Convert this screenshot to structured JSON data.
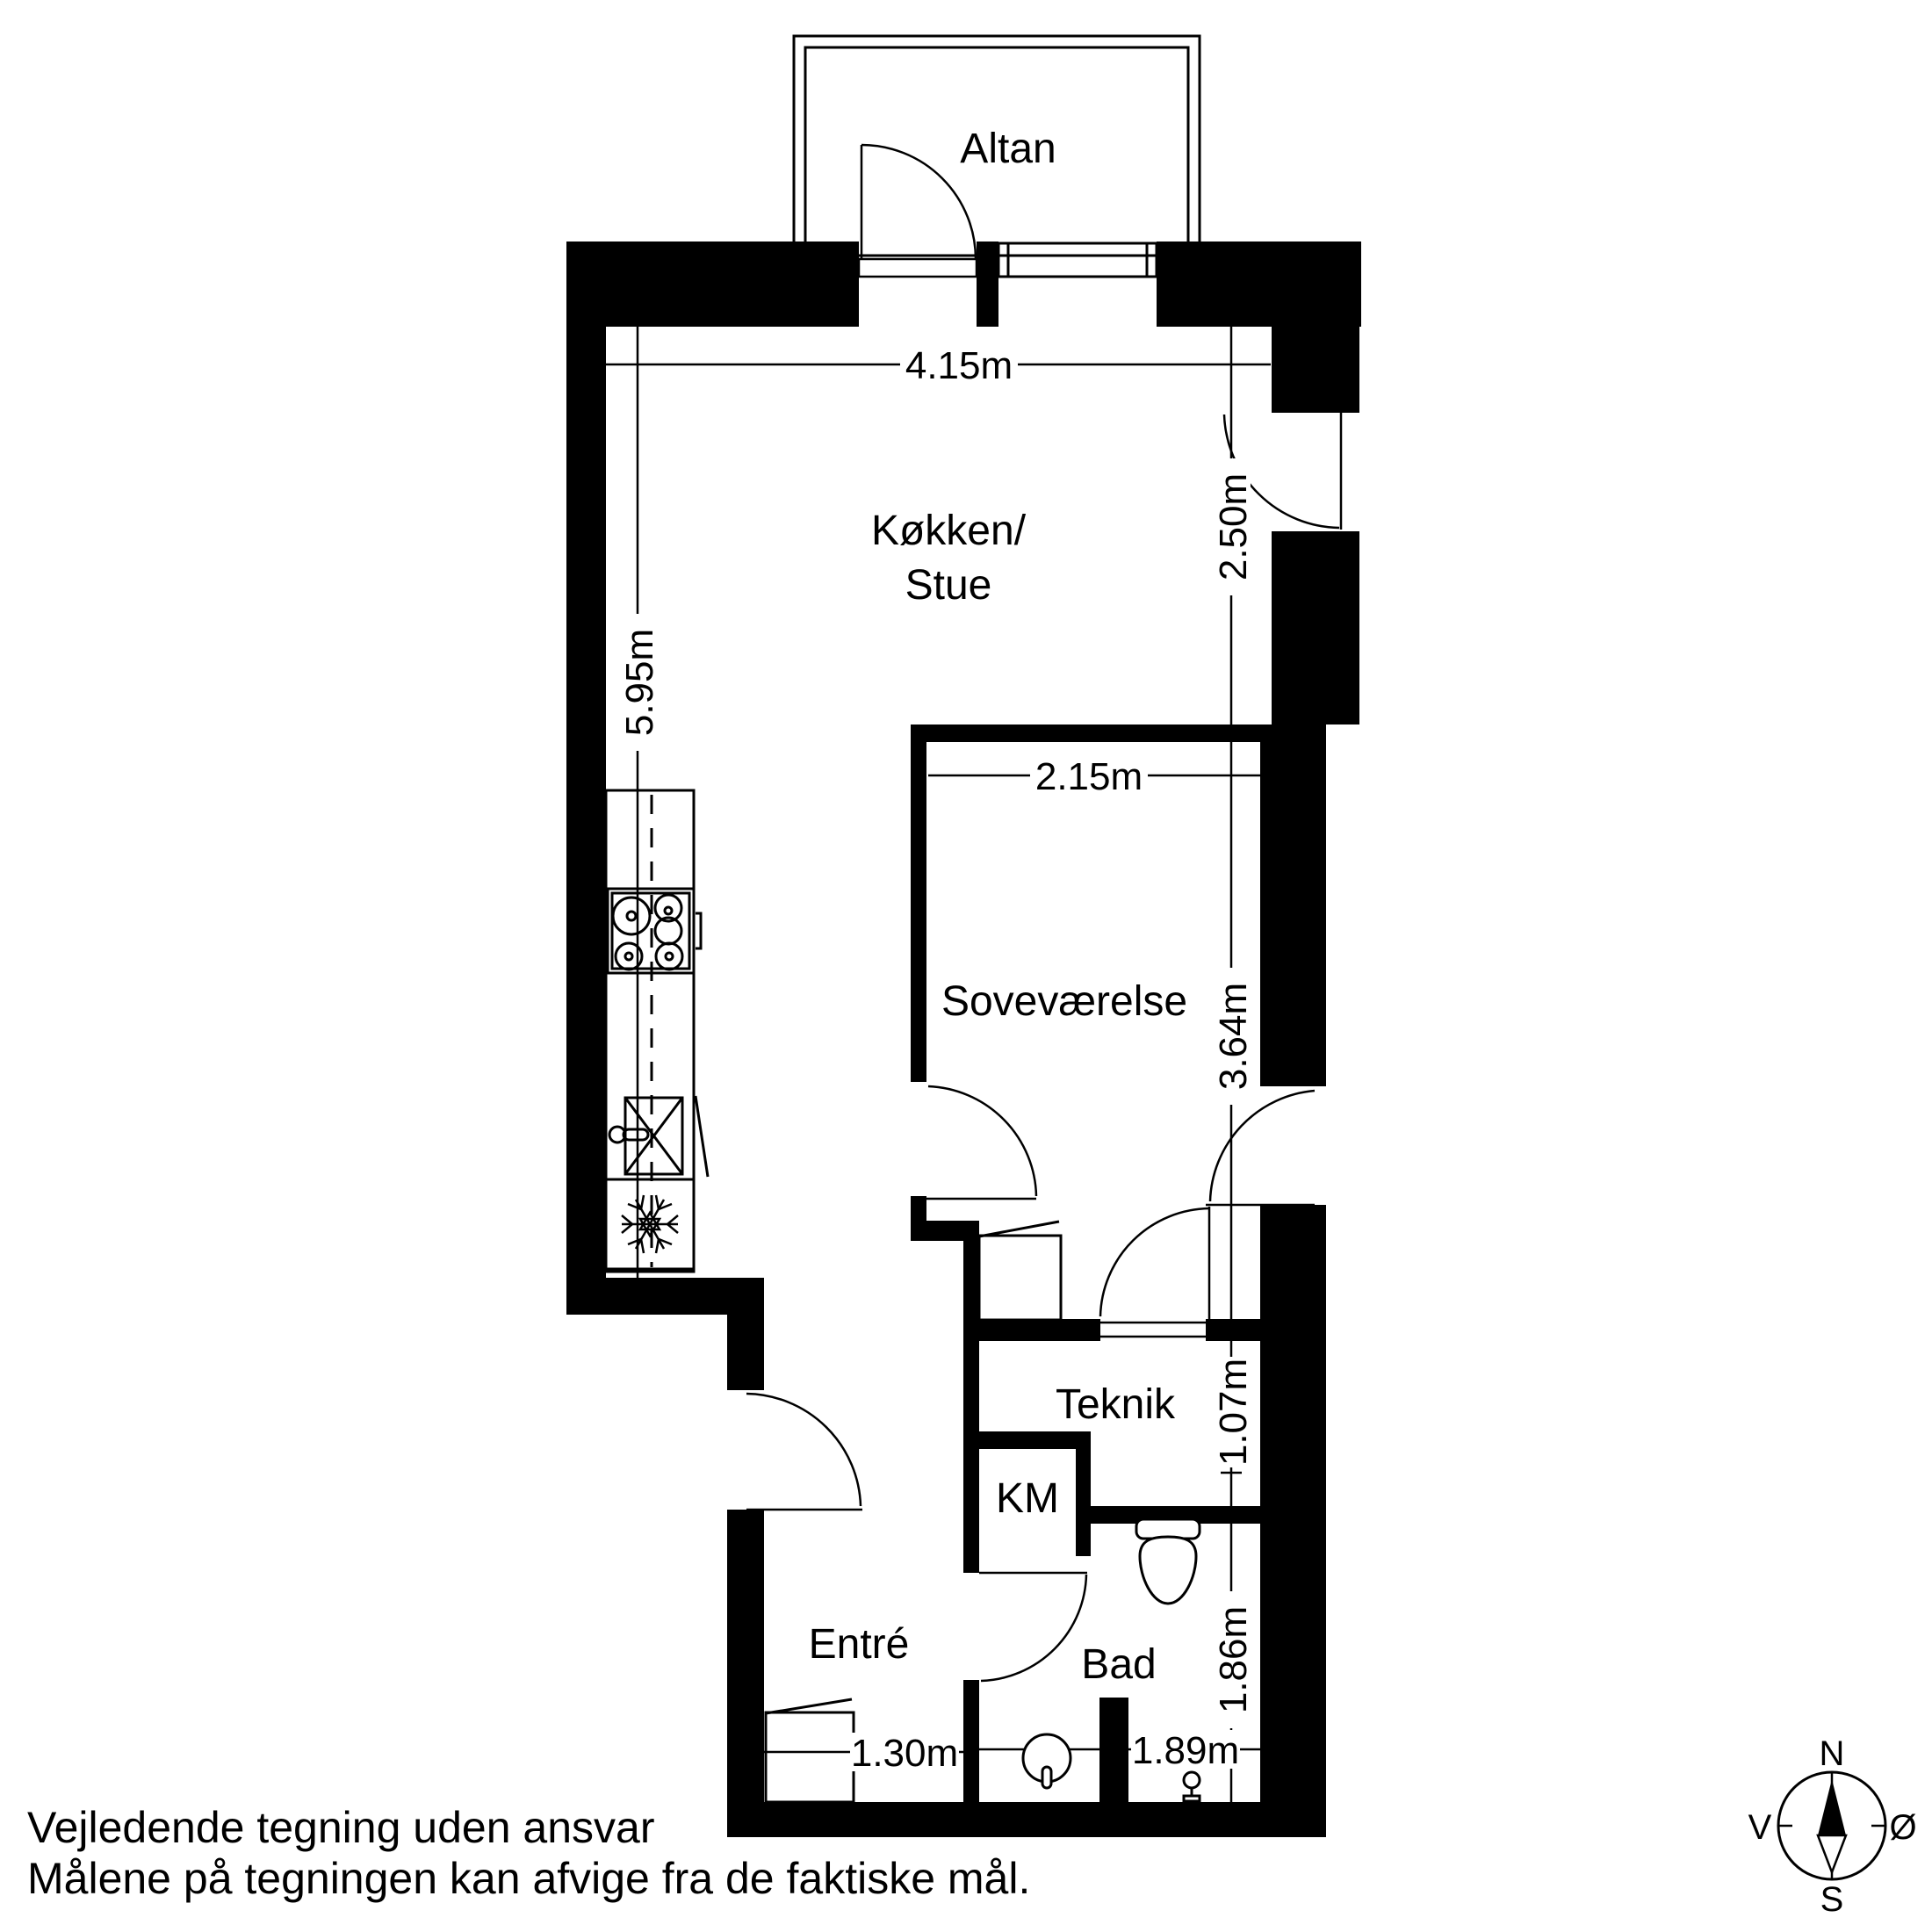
{
  "rooms": {
    "altan": "Altan",
    "kitchen_line1": "Køkken/",
    "kitchen_line2": "Stue",
    "bedroom": "Soveværelse",
    "teknik": "Teknik",
    "km": "KM",
    "entre": "Entré",
    "bad": "Bad"
  },
  "dimensions": {
    "top_width": "4.15m",
    "left_height": "5.95m",
    "right_top": "2.50m",
    "bedroom_width": "2.15m",
    "bedroom_depth": "3.64m",
    "teknik_depth": "1.07m",
    "bad_depth": "1.86m",
    "entre_width": "1.30m",
    "bad_width": "1.89m"
  },
  "compass": {
    "north": "N",
    "south": "S",
    "west": "V",
    "east": "Ø"
  },
  "footer": {
    "line1": "Vejledende tegning uden ansvar",
    "line2": "Målene på tegningen kan afvige fra de faktiske mål."
  },
  "colors": {
    "ink": "#000000",
    "paper": "#ffffff"
  }
}
